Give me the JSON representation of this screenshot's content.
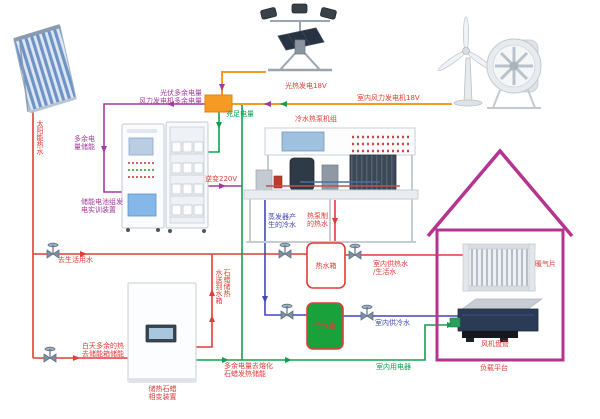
{
  "diagram_type": "energy-system-schematic",
  "labels": {
    "solar_hot_water": "太阳能热水",
    "pv_surplus": "光伏多余电量",
    "wind_surplus": "风力发电机多余电量",
    "pv_output": "光热发电18V",
    "wind_output": "室内风力发电机18V",
    "sufficient_power": "充足电量",
    "surplus_storage": "多余电\n量储能",
    "inverter": "逆变220V",
    "battery_device": "储能电池组发\n电实训装置",
    "heat_pump_unit": "冷水热泵机组",
    "evaporator_cold": "蒸发器产\n生的冷水",
    "heat_pump_hot": "热泵制\n的热水",
    "to_domestic_water": "去生活用水",
    "hot_tank": "热水箱",
    "cold_tank": "冷水箱",
    "paraffin_to_tank": "石蜡储热\n水送到水箱",
    "surplus_melt": "多余电量去熔化\n石蜡发热储能",
    "daytime_surplus": "白天多余的热\n去储能箱储能",
    "indoor_hot_supply": "室内供热水\n/生活水",
    "indoor_cold_supply": "室内供冷水",
    "indoor_appliances": "室内用电器",
    "radiator": "暖气片",
    "fan_coil": "风机盘管",
    "load_platform": "负载平台",
    "paraffin_device": "储热石蜡\n相变装置"
  },
  "colors": {
    "hot_water_line": "#e23c38",
    "cold_water_line": "#4446b8",
    "power_line_green": "#10a14f",
    "surplus_line_purple": "#a43a9f",
    "generation_line_orange": "#f59a23",
    "house_outline": "#b5348f",
    "cold_tank_fill": "#19a23b",
    "valve_grey": "#7d8fa3",
    "charge_node_fill": "#f59a23"
  },
  "equipment": [
    "solar-thermal-collector",
    "pv-panel-stand",
    "wind-turbine",
    "wind-source-fan",
    "control-cabinet",
    "battery-cabinet",
    "heat-pump-unit",
    "paraffin-storage-cabinet",
    "hot-water-tank",
    "cold-water-tank",
    "radiator",
    "fan-coil-unit",
    "house-outline",
    "charge-node",
    "valve"
  ]
}
